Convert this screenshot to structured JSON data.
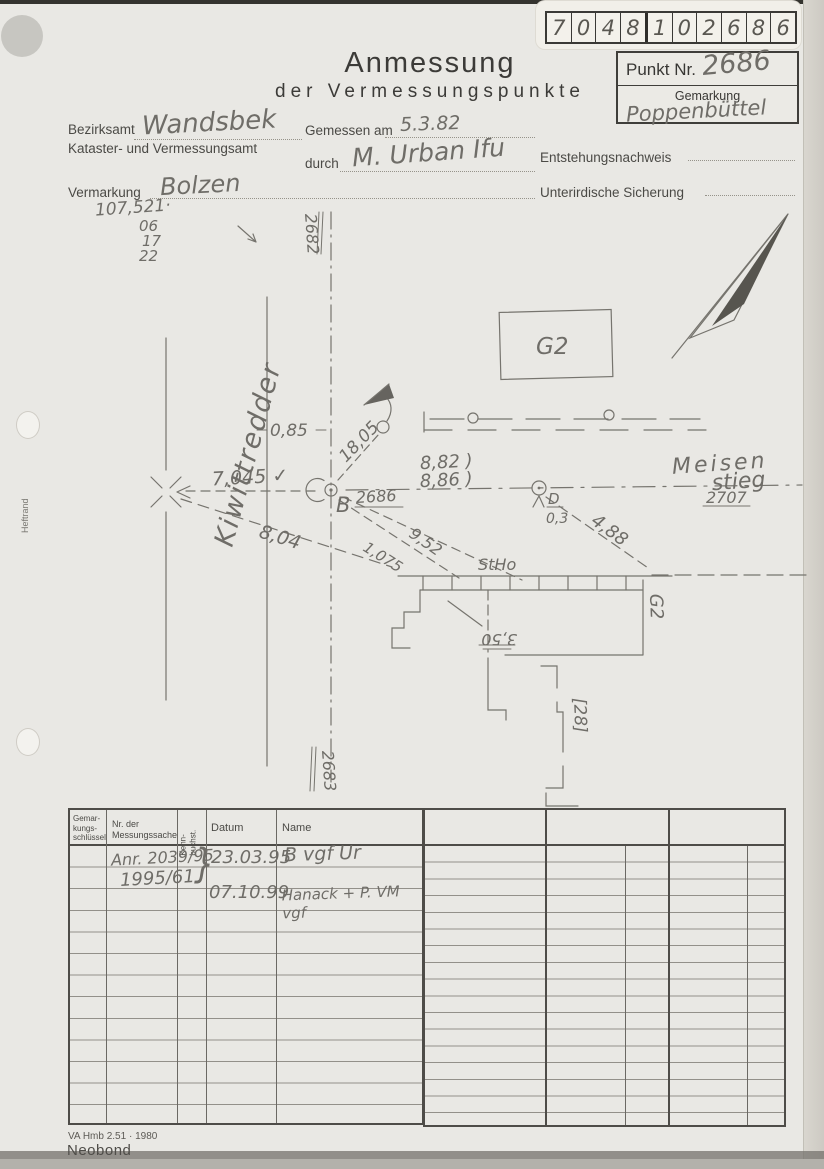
{
  "scan": {
    "code_digits": [
      "7",
      "0",
      "4",
      "8",
      "1",
      "0",
      "2",
      "6",
      "8",
      "6"
    ]
  },
  "header": {
    "title1": "Anmessung",
    "title2": "der Vermessungspunkte",
    "punkt_label": "Punkt Nr.",
    "punkt_value": "2686",
    "gemarkung_label": "Gemarkung",
    "gemarkung_value": "Poppenbüttel"
  },
  "form": {
    "bezirksamt_label": "Bezirksamt",
    "bezirksamt_value": "Wandsbek",
    "amt_line2": "Kataster- und Vermessungsamt",
    "gemessen_label": "Gemessen am",
    "gemessen_value": "5.3.82",
    "durch_label": "durch",
    "durch_value": "M. Urban Ifu",
    "entstehung_label": "Entstehungsnachweis",
    "sicherung_label": "Unterirdische Sicherung",
    "vermarkung_label": "Vermarkung",
    "vermarkung_value": "Bolzen",
    "note1": "107,521·",
    "note2": "06",
    "note3": "17",
    "note4": "22",
    "heftrand": "Heftrand"
  },
  "sketch": {
    "street_left": "Kiwittredder",
    "street_right1": "Meisen",
    "street_right2": "stieg",
    "pt_top": "2682",
    "pt_bottom": "2683",
    "pt_b": "B",
    "pt_b_nr": "2686",
    "pt_d": "D",
    "pt_d_val": "0,3",
    "pt_right_nr": "2707",
    "m_7045": "7,045 ✓",
    "m_085": "0,85",
    "m_1805": "18,05",
    "m_882": "8,82 )",
    "m_886": "8,86 )",
    "m_804": "8,04",
    "m_1075": "1,075",
    "m_952": "9,52",
    "m_488": "4,88",
    "m_350": "3,50",
    "lbl_g2_box": "G2",
    "lbl_g2_side": "G2",
    "lbl_stho": "StHo",
    "lbl_haus": "[28]"
  },
  "table": {
    "h_col1": "Gemar-\nkungs-\nschlüssel",
    "h_col2": "Nr. der\nMessungssache",
    "h_col3": "Kenn-\nbuchst.",
    "h_col4": "Datum",
    "h_col5": "Name",
    "r1_nr": "Anr. 2039/95",
    "r2_nr": "1995/61",
    "brace": "}",
    "r1_datum": "23.03.95",
    "r1_name": "B vgf   Ur",
    "r3_datum": "07.10.99",
    "r3_name": "Hanack + P.  VM vgf"
  },
  "footer": {
    "form_code": "VA Hmb 2.51 · 1980",
    "brand": "Neobond"
  }
}
